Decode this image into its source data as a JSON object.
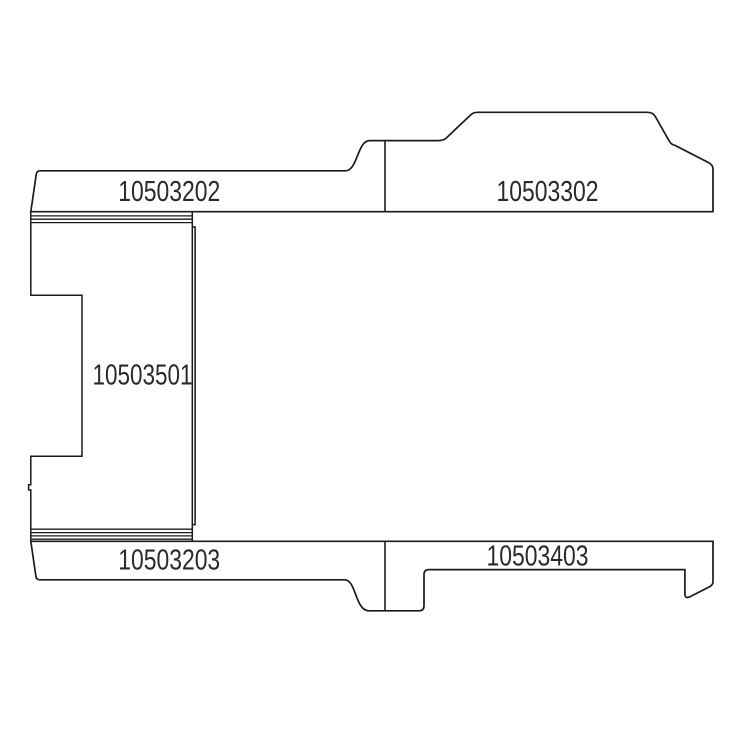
{
  "diagram": {
    "type": "technical-parts-line-drawing",
    "colors": {
      "background": "#ffffff",
      "line": "#1b1b1b",
      "label": "#2a2a2a"
    },
    "parts": [
      {
        "number": "10503202",
        "position": "top-strip-left"
      },
      {
        "number": "10503302",
        "position": "top-strip-right"
      },
      {
        "number": "10503501",
        "position": "middle-left-block"
      },
      {
        "number": "10503203",
        "position": "bottom-strip-left"
      },
      {
        "number": "10503403",
        "position": "bottom-strip-right"
      }
    ]
  }
}
